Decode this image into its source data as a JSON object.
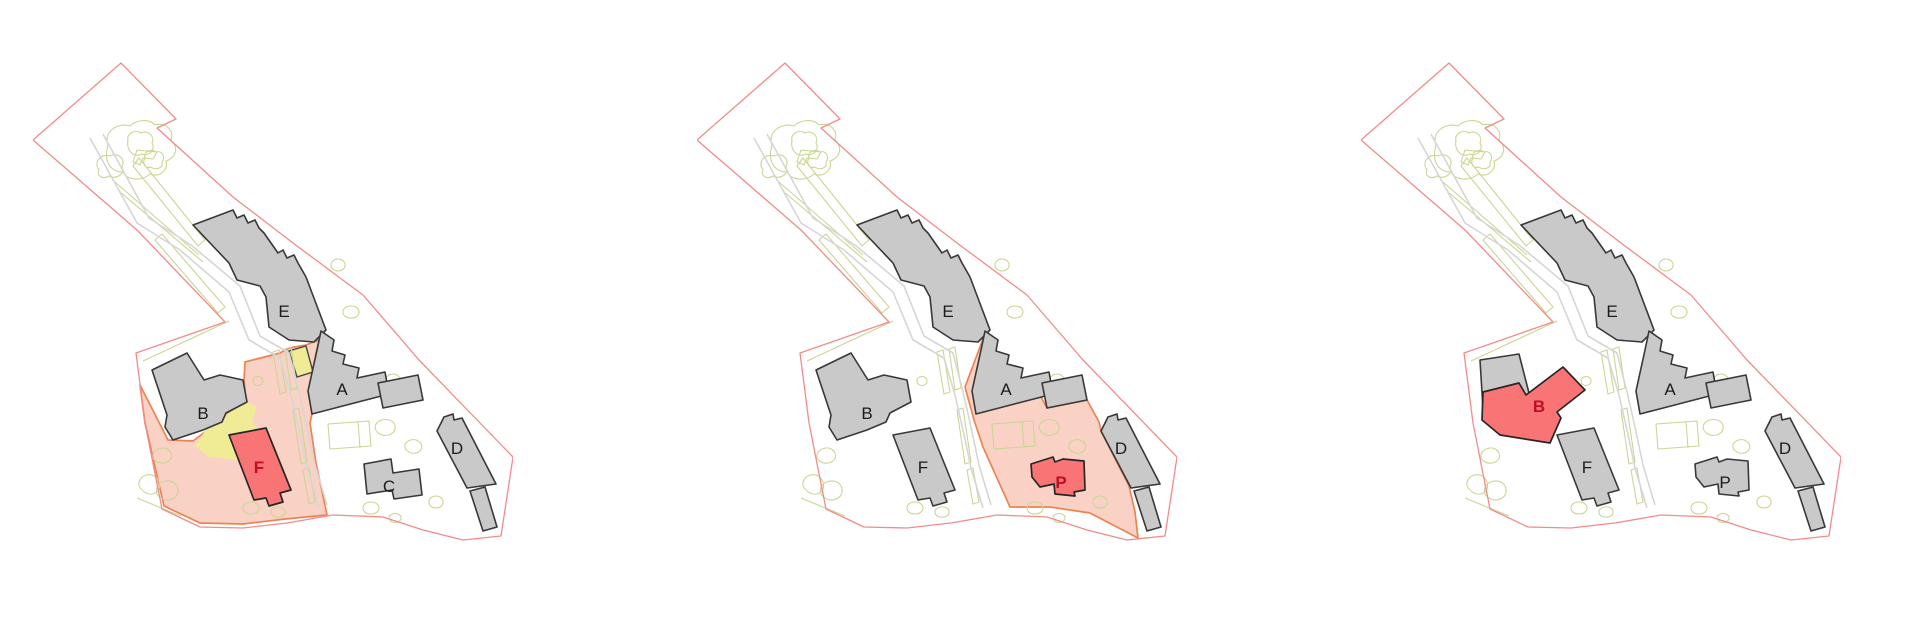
{
  "colors": {
    "background": "#ffffff",
    "site_boundary": "#f28b8b",
    "landscape_line": "#c8d793",
    "road_line": "#d6d6d6",
    "building_fill": "#c9c9c9",
    "building_stroke": "#383838",
    "highlight_fill": "#f97575",
    "highlight_stroke": "#262626",
    "zone_fill": "#f9d2c5",
    "zone_stroke": "#ee8352",
    "yellow_fill": "#f0ec95",
    "yellow_small_stroke": "#444444",
    "label_color": "#1b1b1b",
    "label_highlight_color": "#c00d28"
  },
  "panels": [
    {
      "id": "site-plan-left",
      "zone": "zone1",
      "yellow_patches": true,
      "gray_buildings": [
        "E",
        "A_wing",
        "A_block",
        "B_orig",
        "C",
        "D",
        "D_stub"
      ],
      "highlight_building": "F",
      "labels": [
        {
          "text": "E",
          "pos": "E",
          "style": "normal"
        },
        {
          "text": "B",
          "pos": "B",
          "style": "normal"
        },
        {
          "text": "A",
          "pos": "A",
          "style": "normal"
        },
        {
          "text": "C",
          "pos": "C",
          "style": "normal"
        },
        {
          "text": "D",
          "pos": "D",
          "style": "normal"
        },
        {
          "text": "F",
          "pos": "F",
          "style": "highlight"
        }
      ]
    },
    {
      "id": "site-plan-middle",
      "zone": "zone2",
      "yellow_patches": false,
      "gray_buildings": [
        "E",
        "A_wing",
        "A_block",
        "B_orig",
        "F",
        "D",
        "D_stub"
      ],
      "highlight_building": "P",
      "labels": [
        {
          "text": "E",
          "pos": "E",
          "style": "normal"
        },
        {
          "text": "B",
          "pos": "B",
          "style": "normal"
        },
        {
          "text": "A",
          "pos": "A",
          "style": "normal"
        },
        {
          "text": "F",
          "pos": "F",
          "style": "normal"
        },
        {
          "text": "D",
          "pos": "D",
          "style": "normal"
        },
        {
          "text": "P",
          "pos": "P",
          "style": "highlight"
        }
      ]
    },
    {
      "id": "site-plan-right",
      "zone": null,
      "yellow_patches": false,
      "gray_buildings": [
        "E",
        "A_wing",
        "A_block",
        "B_remnant",
        "F",
        "P",
        "D",
        "D_stub"
      ],
      "highlight_building": "B_new",
      "labels": [
        {
          "text": "E",
          "pos": "E",
          "style": "normal"
        },
        {
          "text": "A",
          "pos": "A",
          "style": "normal"
        },
        {
          "text": "F",
          "pos": "F",
          "style": "normal"
        },
        {
          "text": "D",
          "pos": "D",
          "style": "normal"
        },
        {
          "text": "P",
          "pos": "P",
          "style": "normal"
        },
        {
          "text": "B",
          "pos": "B_new",
          "style": "highlight"
        }
      ]
    }
  ]
}
